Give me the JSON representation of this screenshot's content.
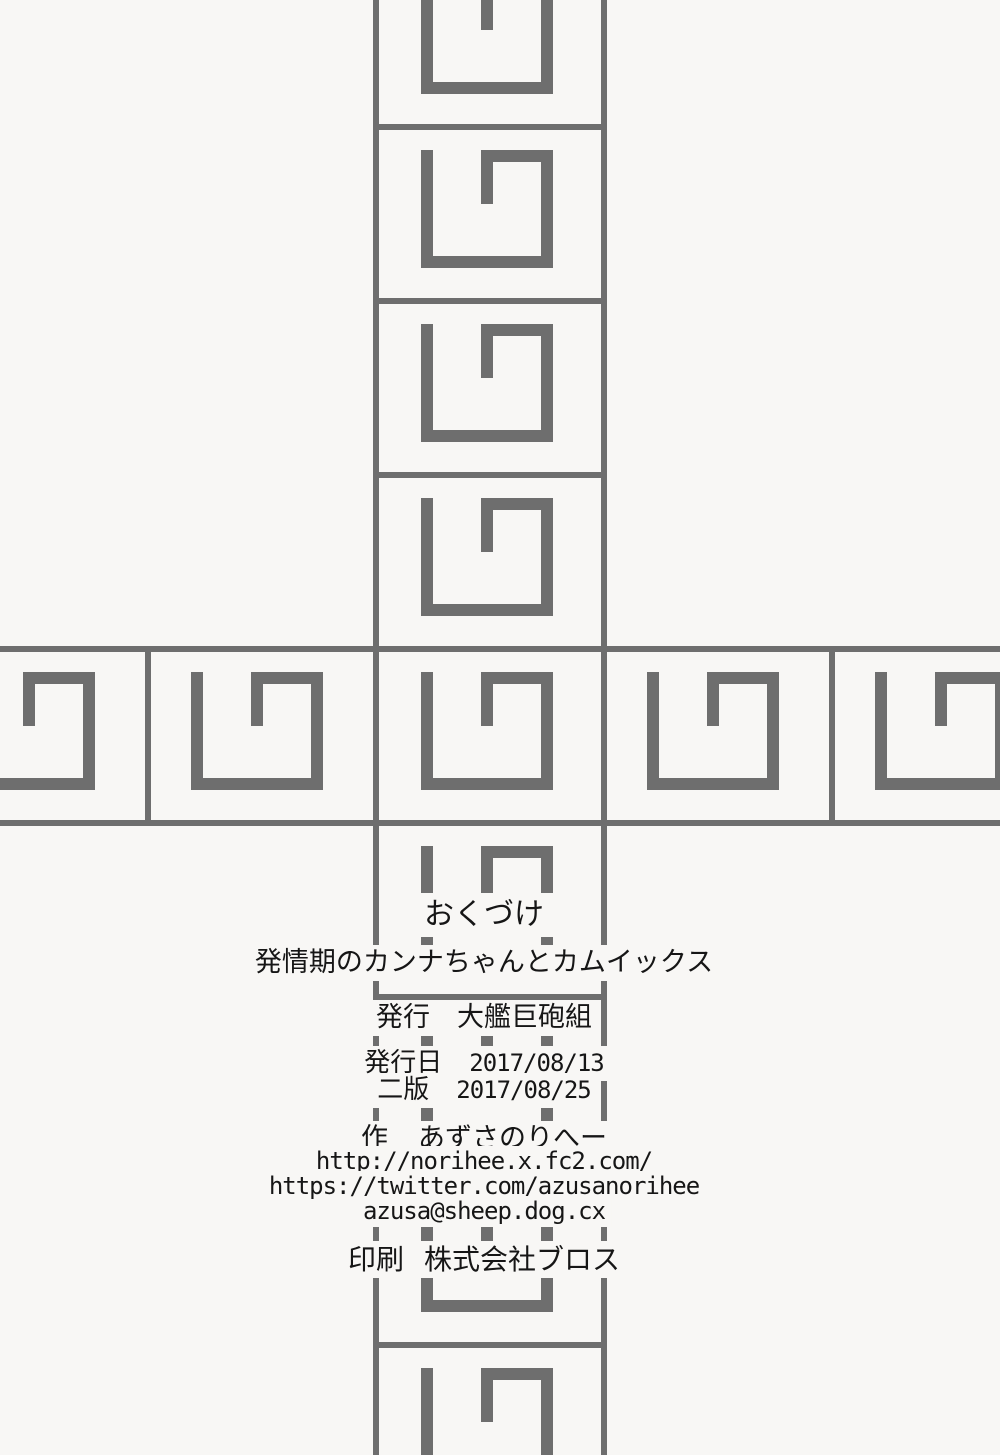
{
  "page": {
    "bg_color": "#f8f7f5",
    "pattern_color": "#6e6e6e",
    "text_color": "#161616"
  },
  "colophon": {
    "heading": "おくづけ",
    "title": "発情期のカンナちゃんとカムイックス",
    "publisher_label": "発行",
    "publisher": "大艦巨砲組",
    "pubdate_label": "発行日",
    "pubdate": "2017/08/13",
    "edition_label": "二版",
    "edition_date": "2017/08/25",
    "author_label": "作",
    "author": "あずさのりへー",
    "website": "http://norihee.x.fc2.com/",
    "twitter": "https://twitter.com/azusanorihee",
    "email": "azusa@sheep.dog.cx",
    "printer_label": "印刷",
    "printer": "株式会社ブロス"
  }
}
